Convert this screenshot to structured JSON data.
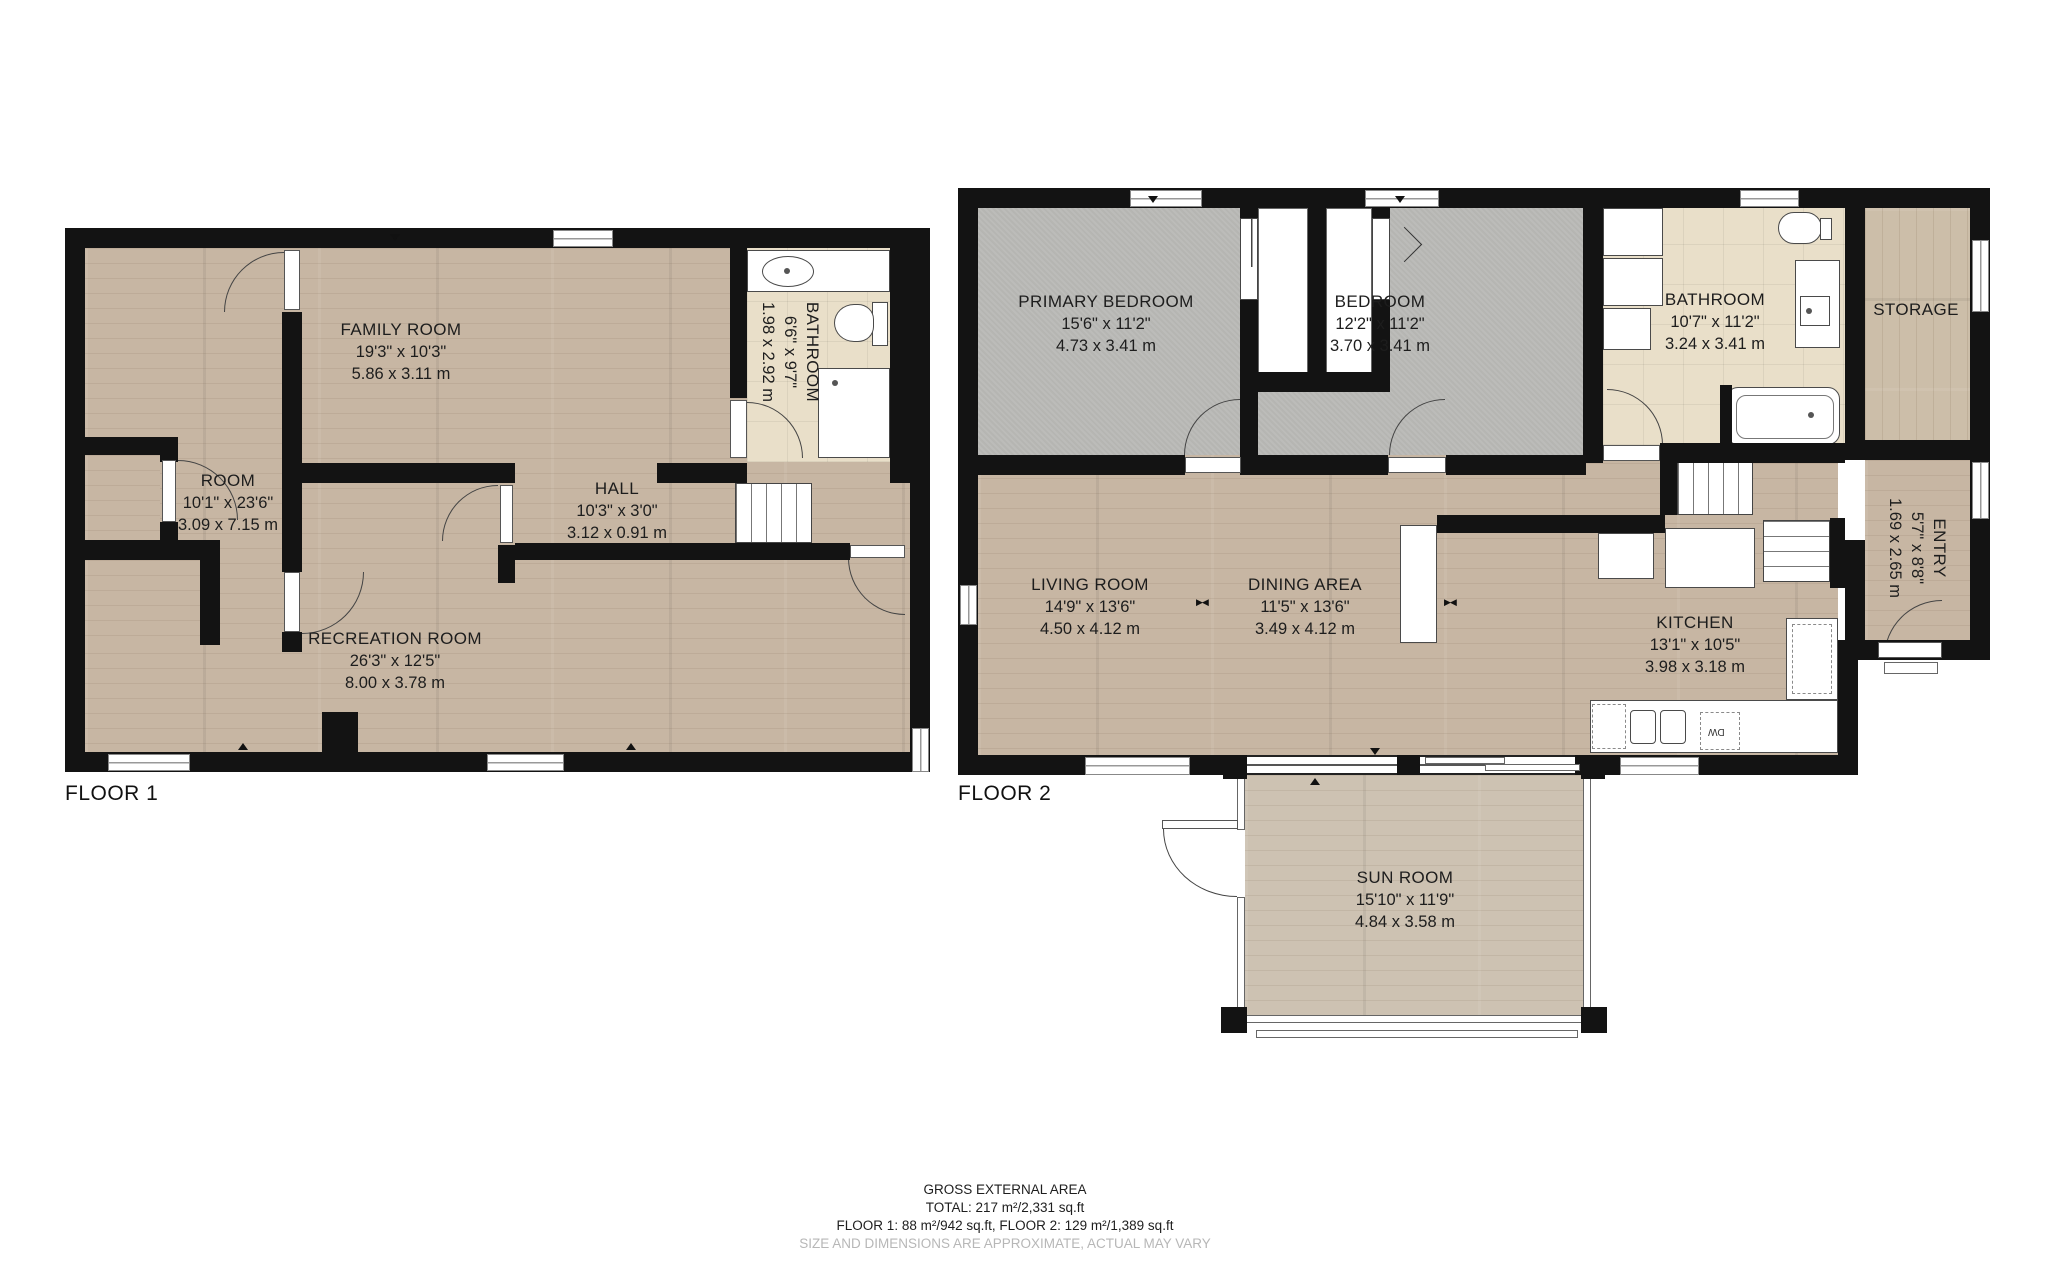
{
  "floor1": {
    "label": "FLOOR 1",
    "rooms": {
      "family_room": {
        "name": "FAMILY ROOM",
        "imperial": "19'3\" x 10'3\"",
        "metric": "5.86 x 3.11 m"
      },
      "room": {
        "name": "ROOM",
        "imperial": "10'1\" x 23'6\"",
        "metric": "3.09 x 7.15 m"
      },
      "hall": {
        "name": "HALL",
        "imperial": "10'3\" x 3'0\"",
        "metric": "3.12 x 0.91 m"
      },
      "bathroom": {
        "name": "BATHROOM",
        "imperial": "6'6\" x 9'7\"",
        "metric": "1.98 x 2.92 m"
      },
      "recreation_room": {
        "name": "RECREATION ROOM",
        "imperial": "26'3\" x 12'5\"",
        "metric": "8.00 x 3.78 m"
      }
    }
  },
  "floor2": {
    "label": "FLOOR 2",
    "rooms": {
      "primary_bedroom": {
        "name": "PRIMARY BEDROOM",
        "imperial": "15'6\" x 11'2\"",
        "metric": "4.73 x 3.41 m"
      },
      "bedroom": {
        "name": "BEDROOM",
        "imperial": "12'2\" x 11'2\"",
        "metric": "3.70 x 3.41 m"
      },
      "bathroom": {
        "name": "BATHROOM",
        "imperial": "10'7\" x 11'2\"",
        "metric": "3.24 x 3.41 m"
      },
      "storage": {
        "name": "STORAGE"
      },
      "living_room": {
        "name": "LIVING ROOM",
        "imperial": "14'9\" x 13'6\"",
        "metric": "4.50 x 4.12 m"
      },
      "dining_area": {
        "name": "DINING AREA",
        "imperial": "11'5\" x 13'6\"",
        "metric": "3.49 x 4.12 m"
      },
      "kitchen": {
        "name": "KITCHEN",
        "imperial": "13'1\" x 10'5\"",
        "metric": "3.98 x 3.18 m"
      },
      "entry": {
        "name": "ENTRY",
        "imperial": "5'7\" x 8'8\"",
        "metric": "1.69 x 2.65 m"
      },
      "sun_room": {
        "name": "SUN ROOM",
        "imperial": "15'10\" x 11'9\"",
        "metric": "4.84 x 3.58 m"
      }
    }
  },
  "fixtures": {
    "dishwasher_label": "DW"
  },
  "icons": {
    "area_divider_glyph": "▶◀"
  },
  "footer": {
    "line1": "GROSS EXTERNAL AREA",
    "line2": "TOTAL: 217 m²/2,331 sq.ft",
    "line3": "FLOOR 1: 88 m²/942 sq.ft, FLOOR 2: 129 m²/1,389 sq.ft",
    "disclaimer": "SIZE AND DIMENSIONS ARE APPROXIMATE, ACTUAL MAY VARY"
  },
  "colors": {
    "wall": "#131313",
    "wood": "#c7b6a3",
    "carpet": "#bcbcb9",
    "tile": "#e9dfc9",
    "disclaimer_text": "#b7b7b7"
  }
}
